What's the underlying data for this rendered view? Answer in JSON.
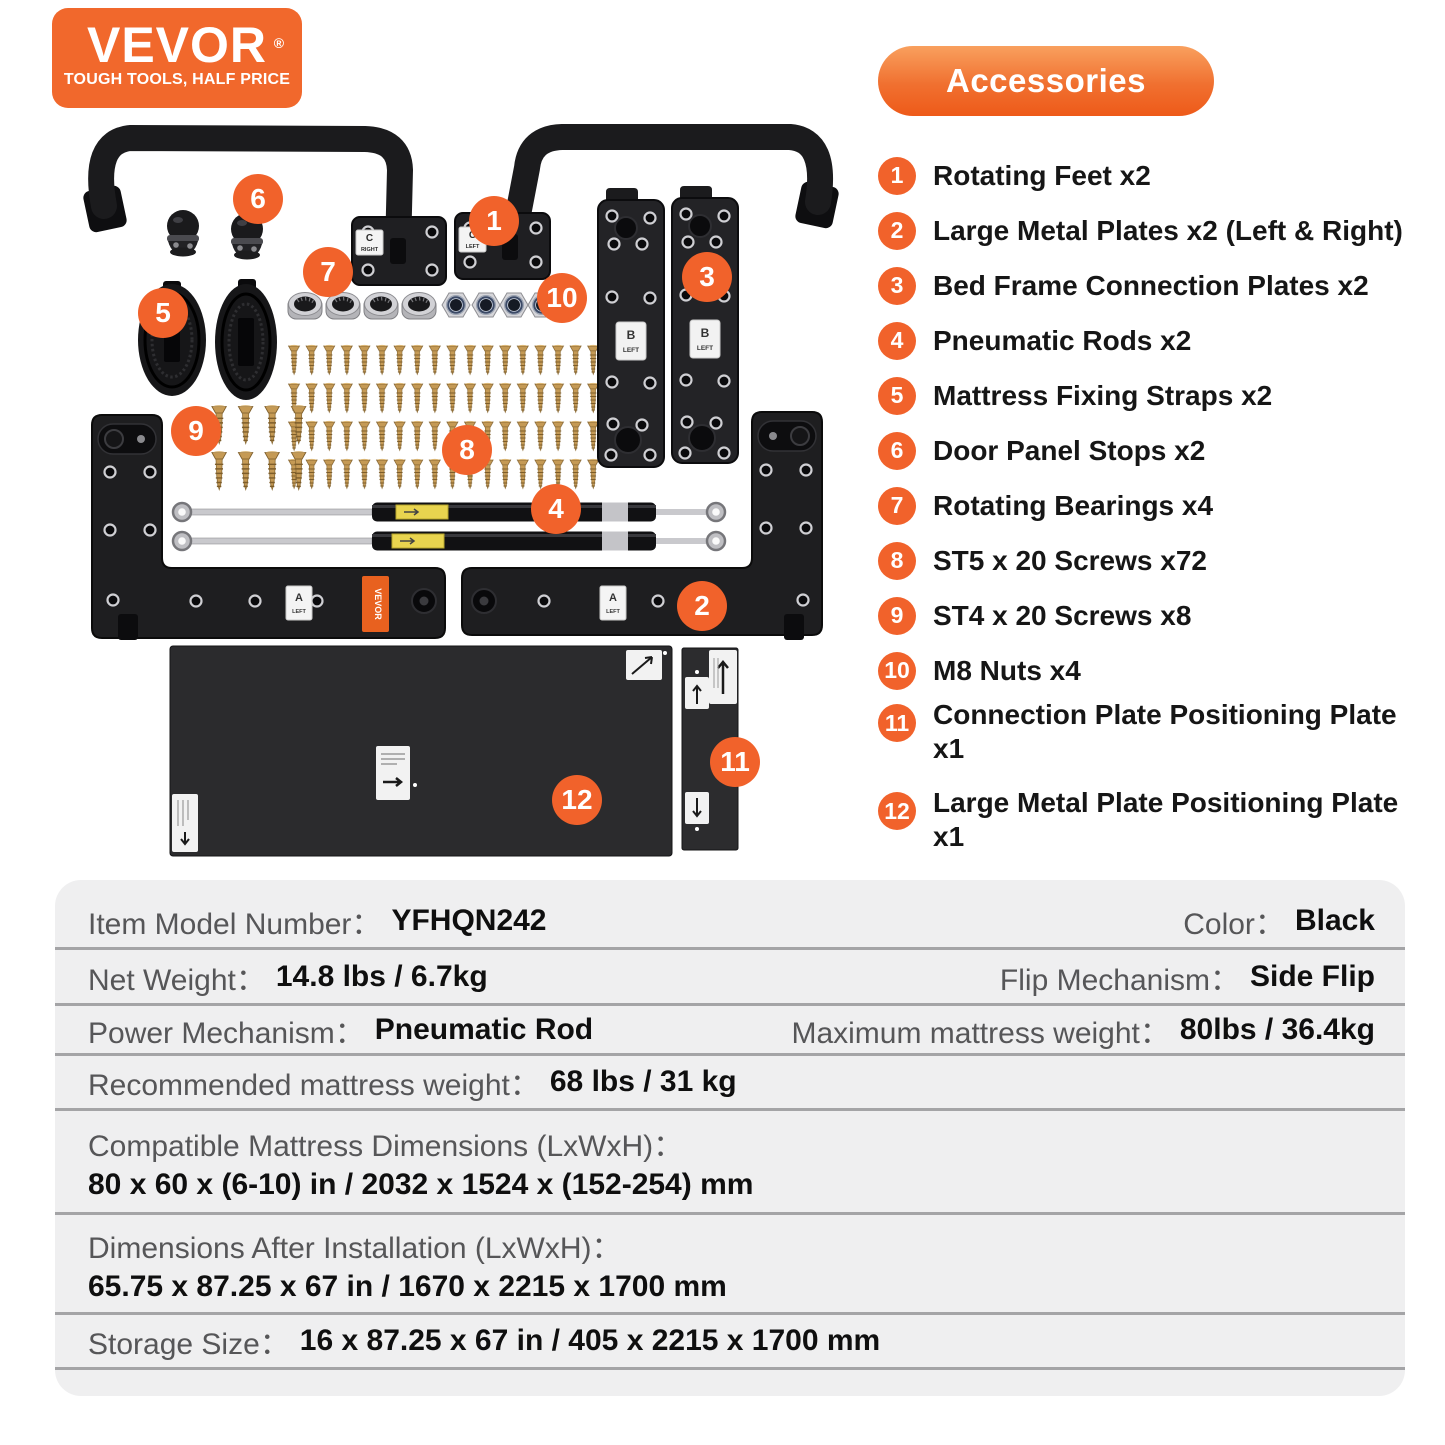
{
  "logo": {
    "brand": "VEVOR",
    "registered": "®",
    "tagline": "TOUGH TOOLS, HALF PRICE"
  },
  "accessories": {
    "title": "Accessories",
    "items": [
      {
        "number": "1",
        "label": "Rotating Feet x2"
      },
      {
        "number": "2",
        "label": "Large Metal Plates x2 (Left & Right)"
      },
      {
        "number": "3",
        "label": "Bed Frame Connection Plates x2"
      },
      {
        "number": "4",
        "label": "Pneumatic Rods x2"
      },
      {
        "number": "5",
        "label": "Mattress Fixing Straps x2"
      },
      {
        "number": "6",
        "label": "Door Panel Stops x2"
      },
      {
        "number": "7",
        "label": "Rotating Bearings x4"
      },
      {
        "number": "8",
        "label": "ST5 x 20 Screws x72"
      },
      {
        "number": "9",
        "label": "ST4 x 20 Screws x8"
      },
      {
        "number": "10",
        "label": "M8 Nuts x4"
      },
      {
        "number": "11",
        "label": "Connection Plate Positioning Plate x1"
      },
      {
        "number": "12",
        "label": "Large Metal Plate Positioning Plate x1"
      }
    ]
  },
  "diagram": {
    "callouts": [
      "1",
      "2",
      "3",
      "4",
      "5",
      "6",
      "7",
      "8",
      "9",
      "10",
      "11",
      "12"
    ],
    "part_labels": {
      "c_right_line1": "C",
      "c_right_line2": "RIGHT",
      "c_left_line1": "C",
      "c_left_line2": "LEFT",
      "b_line1": "B",
      "b_line2": "LEFT",
      "a_line1": "A",
      "a_line2": "LEFT",
      "sticker": "VEVOR"
    }
  },
  "specs": {
    "rows": [
      {
        "label": "Item Model Number：",
        "value": "YFHQN242",
        "label2": "Color：",
        "value2": "Black"
      },
      {
        "label": "Net Weight：",
        "value": "14.8 lbs / 6.7kg",
        "label2": "Flip Mechanism：",
        "value2": "Side Flip"
      },
      {
        "label": "Power Mechanism：",
        "value": "Pneumatic Rod",
        "label2": "Maximum mattress weight：",
        "value2": "80lbs / 36.4kg"
      },
      {
        "label": "Recommended mattress weight：",
        "value": "68 lbs / 31 kg"
      },
      {
        "label": "Compatible Mattress Dimensions (LxWxH)：",
        "value": "80 x 60 x (6-10) in / 2032 x 1524 x (152-254) mm"
      },
      {
        "label": "Dimensions After Installation (LxWxH)：",
        "value": "65.75 x 87.25 x 67 in / 1670 x 2215 x 1700 mm"
      },
      {
        "label": "Storage Size：",
        "value": "16 x 87.25 x 67 in / 405 x 2215 x 1700 mm"
      }
    ]
  },
  "colors": {
    "accent": "#f1682c",
    "table_bg": "#efeff0",
    "divider": "#a4a4a6"
  }
}
